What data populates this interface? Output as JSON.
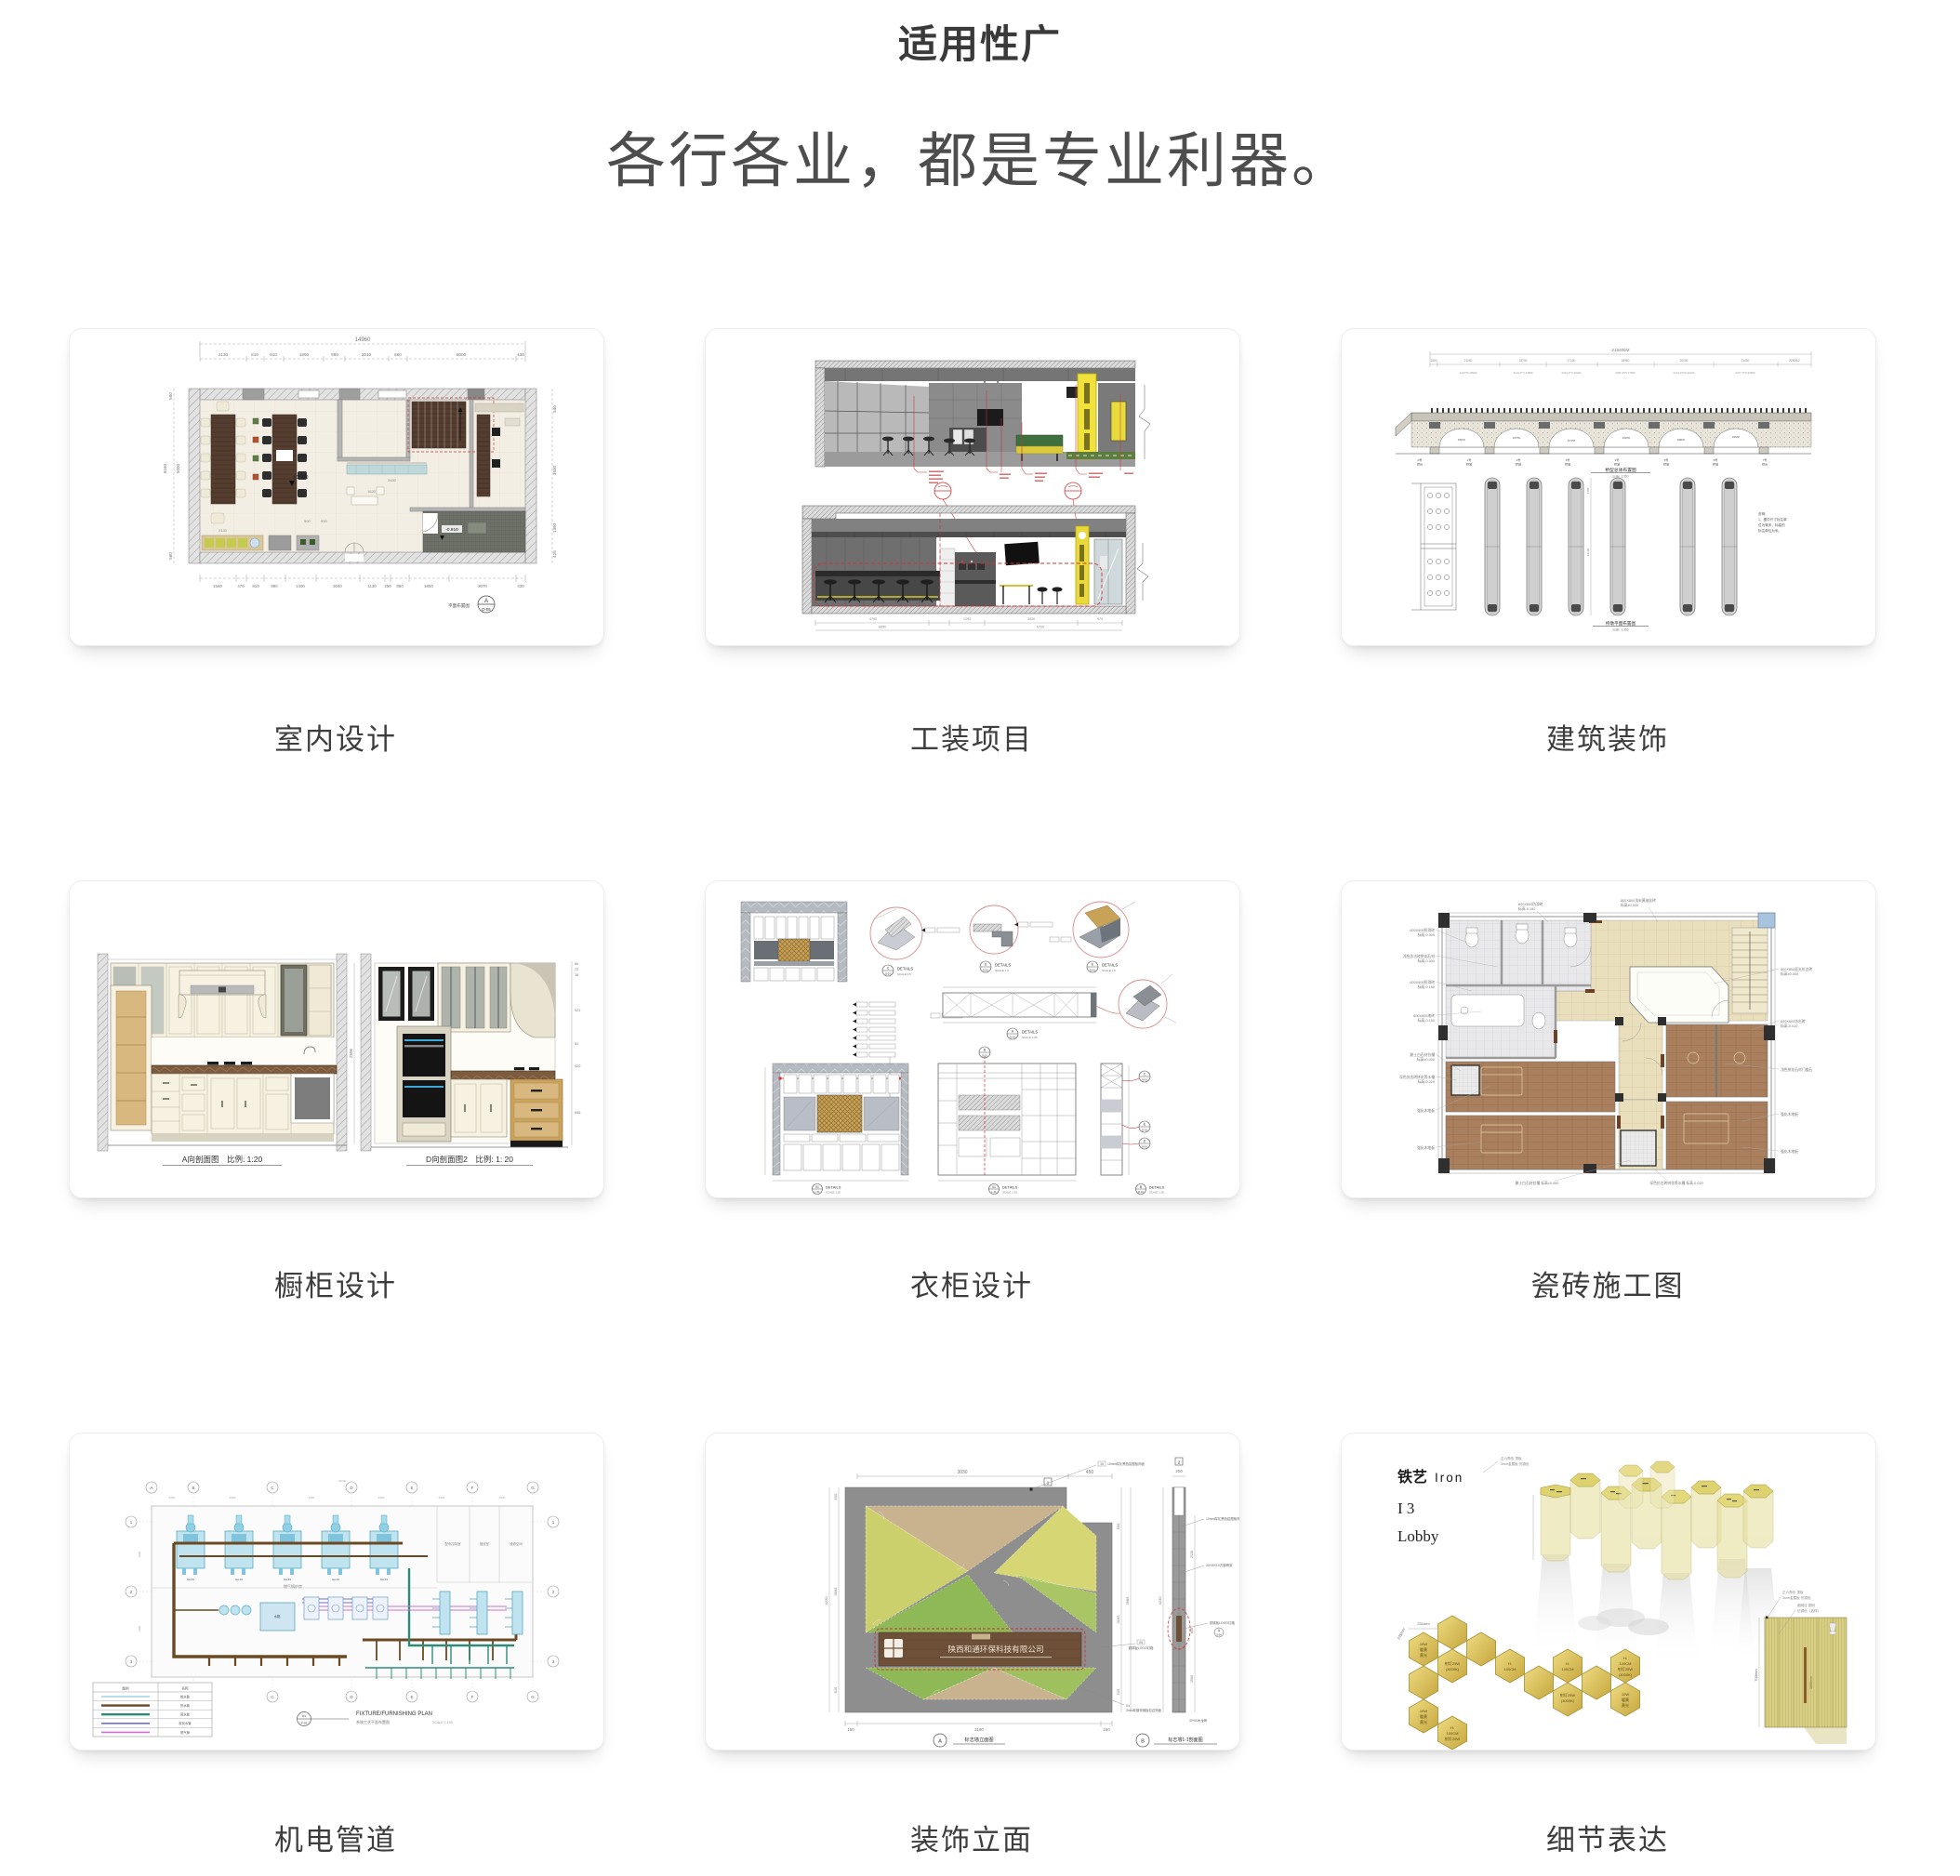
{
  "page": {
    "title": "适用性广",
    "subtitle": "各行各业，都是专业利器。"
  },
  "cards": [
    {
      "label": "室内设计",
      "top_total": "14960",
      "top": [
        "2130",
        "810",
        "910",
        "1850",
        "960",
        "2010",
        "860",
        "5000",
        "430"
      ],
      "bottom": [
        "1660",
        "470",
        "810",
        "990",
        "1400",
        "2040",
        "1130",
        "250",
        "860",
        "1850",
        "3070",
        "430"
      ],
      "left": [
        "580",
        "6160",
        "5000",
        "580"
      ],
      "right": [
        "540",
        "3530",
        "1390",
        "425"
      ],
      "lv0": "±0.000",
      "lv1": "-0.910",
      "inner": [
        "3480",
        "1620",
        "2130",
        "900",
        "900"
      ],
      "ref_letter": "A",
      "ref_num": "D-05",
      "ref_title": "平面布置图"
    },
    {
      "label": "工装项目",
      "dims": [
        "4790",
        "1293",
        "3430",
        "974"
      ],
      "totals": [
        "6850",
        "6730"
      ]
    },
    {
      "label": "建筑装饰",
      "total": "215400/2",
      "spans": [
        "2500",
        "21050",
        "15700",
        "17100",
        "18950",
        "20000",
        "21400",
        "22806/2"
      ],
      "formulas": [
        "2110*9=18990",
        "2114.2*7=14800",
        "2314.2*7=16200",
        "2206.2*8=17650",
        "2122.22*9=19100",
        "2277.7*9=20500"
      ],
      "radii": [
        "R5630",
        "R6750",
        "R7450",
        "R8250",
        "R8830",
        "R9350"
      ],
      "piers": [
        "0号",
        "1号",
        "2号",
        "3号",
        "4号",
        "5号",
        "6号",
        "7号"
      ],
      "pier_sub": "桥墩",
      "pier_sub0": "桥台",
      "dim_v": "24190",
      "dim_v2": "4105",
      "note": [
        "说明:",
        "1、图中尺寸标注单",
        "位为毫米，标高的",
        "标注单位为米。"
      ],
      "t1": "桥型总体布置图",
      "s1": "scale: 1:350",
      "t2": "桥墩平面布置图",
      "s2": "scale: 1:350"
    },
    {
      "label": "橱柜设计",
      "t1": "A向剖面图　比例: 1:20",
      "t2": "D向剖面图2　比例: 1: 20",
      "dl": "2506",
      "dr": [
        "60",
        "72",
        "16",
        "921",
        "51",
        "520",
        "846"
      ]
    },
    {
      "label": "衣柜设计",
      "w": "DETAILS",
      "s5": "SCALE 1:5",
      "s25": "SCALE 1:25",
      "c_top": [
        "C",
        "D",
        "E"
      ],
      "c_mid": "A",
      "c_b": "B",
      "c_bl": "01",
      "c_bm": "01",
      "c_br": "B",
      "ref": "D-01",
      "ref2": "L-01"
    },
    {
      "label": "瓷砖施工图",
      "nl": [
        [
          "600X600防滑砖",
          "标高-0.300"
        ],
        [
          "浅色仿古砖拼花石材",
          "标高-0.300"
        ],
        [
          "600X600防滑砖",
          "标高-0.150"
        ],
        [
          "600X600地砖",
          "标高-0.150"
        ],
        [
          "爵士白石材拉槽",
          "标高±0.000"
        ],
        [
          "深色仿古砖拼花等水槽",
          "标高-0.020"
        ],
        [
          "强化木地板",
          ""
        ],
        [
          "强化木地板",
          ""
        ]
      ],
      "nt": [
        [
          "600X600防滑砖",
          "标高-0.150"
        ],
        [
          "800X800浅米黄玻化砖",
          "标高±0.000"
        ]
      ],
      "nr": [
        [
          "800X800亚光仿古砖",
          "标高±0.000"
        ],
        [
          "600X600仿古砖",
          "标高-0.010"
        ],
        [
          "浅色拼花石材门槛石",
          ""
        ],
        [
          "强化木地板",
          ""
        ],
        [
          "强化木地板",
          ""
        ]
      ],
      "nb": [
        "爵士白石材拉槽 标高±0.000",
        "深色仿古砖拼花等水槽 标高-0.020"
      ]
    },
    {
      "label": "机电管道",
      "letters": [
        "A",
        "B",
        "C",
        "D",
        "E",
        "F",
        "G"
      ],
      "nums": [
        "1",
        "2",
        "3"
      ],
      "rooms": [
        "配电控制室",
        "值班室",
        "维修空间"
      ],
      "boiler_room": "燃气锅炉房",
      "unit": "GA-01",
      "tank": "水箱",
      "dim_top": "45000",
      "dim_seg": "8400",
      "dim_l": [
        "9000",
        "6000"
      ],
      "legend_c1": "图例",
      "legend_c2": "名称",
      "legend": [
        "给水管",
        "热水管",
        "回水管",
        "软化水管",
        "燃气管"
      ],
      "ref_t": "01",
      "ref_b": "P-03",
      "title_en": "FIXTURE/FURNISHING PLAN",
      "title_cn": "系统工艺平面布置图",
      "scale": "SCALE 1:100"
    },
    {
      "label": "装饰立面",
      "d_top": [
        "3030",
        "450"
      ],
      "d_l": [
        "150",
        "3565",
        "515"
      ],
      "d_l_total": "4230",
      "d_r": [
        "550",
        "3165",
        "515"
      ],
      "d_r_total": "3689",
      "d_b": [
        "150",
        "3180",
        "150"
      ],
      "sec_top": "200",
      "sec_l": "4230",
      "sec_r": [
        "2130",
        "600",
        "1500"
      ],
      "company": "陕西和通环保科技有限公司",
      "ann": [
        [
          "15",
          "10mm厚灰黑色铝塑板饰面"
        ],
        [
          "10",
          "30*30*3.0方钢骨架"
        ],
        [
          "06",
          "铜锈板LOGO灯箱"
        ],
        [
          "04",
          "3mm厚镀锌钢板包边饰面"
        ],
        [
          "41",
          "30*50木龙骨"
        ]
      ],
      "refA": "A",
      "refB": "B",
      "refD": "D-04",
      "tA": "标志墙立面图",
      "tB": "标志墙1-1剖面图",
      "mark": "1",
      "mark2": "2"
    },
    {
      "label": "细节表达",
      "t_cn": "铁艺",
      "t_en": "Iron",
      "t_i3": "I 3",
      "t_lobby": "Lobby",
      "ann1": [
        "正六角形 顶板",
        "3mm金属板 仿铜色"
      ],
      "ann2": [
        "细网目 铜网",
        "仿铜色（选样）"
      ],
      "hx_10w": [
        "10W",
        "暖黄",
        "黄光"
      ],
      "hx_spot": [
        "射灯25W",
        "(3000K)"
      ],
      "hx_h": [
        "H:",
        "100CM"
      ],
      "d1": "231mm",
      "d2": "231mm",
      "d3": "700mm",
      "d4": "1000mm"
    }
  ]
}
